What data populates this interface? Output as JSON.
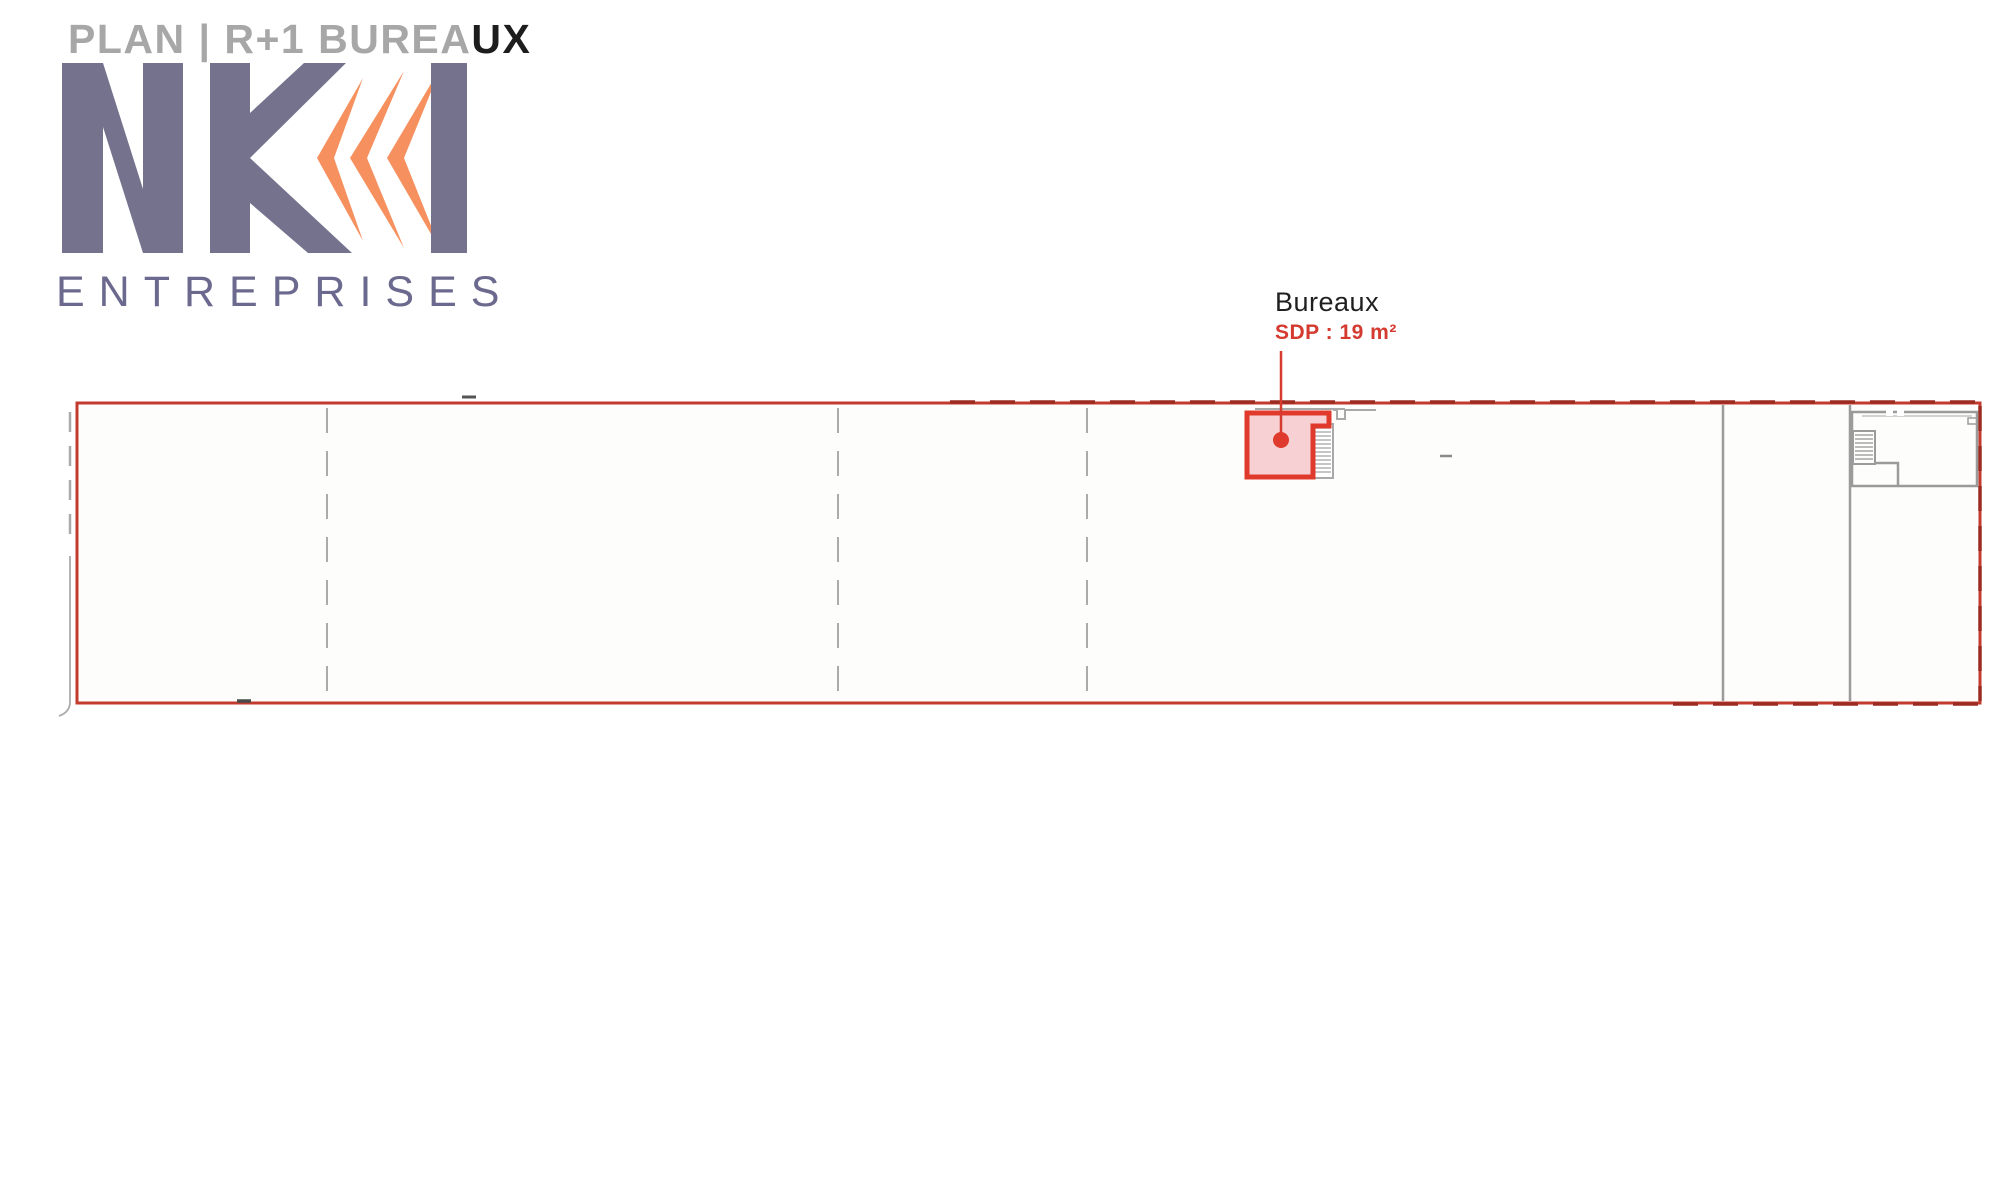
{
  "header": {
    "title": {
      "primary": "PLAN | R+1 BUREA",
      "suffix": "UX"
    },
    "logo": {
      "text": "NKI",
      "subtitle": "ENTREPRISES"
    }
  },
  "plan": {
    "room_label": {
      "name": "Bureaux",
      "area": "SDP : 19 m²"
    }
  },
  "colors": {
    "accent_red": "#d63b30",
    "plan_border_red": "#c33a2e",
    "dashed_border_red": "#9c2b22",
    "room_fill_pink": "#f6d0d2",
    "room_outline_red": "#e03a2c",
    "wall_gray": "#9b9b9b",
    "partition_gray": "#ababab",
    "logo_purple": "#75728e",
    "logo_orange": "#f6915f",
    "title_gray": "#a7a7a7",
    "title_black": "#1d1d1d",
    "label_text": "#1f1f1f"
  }
}
